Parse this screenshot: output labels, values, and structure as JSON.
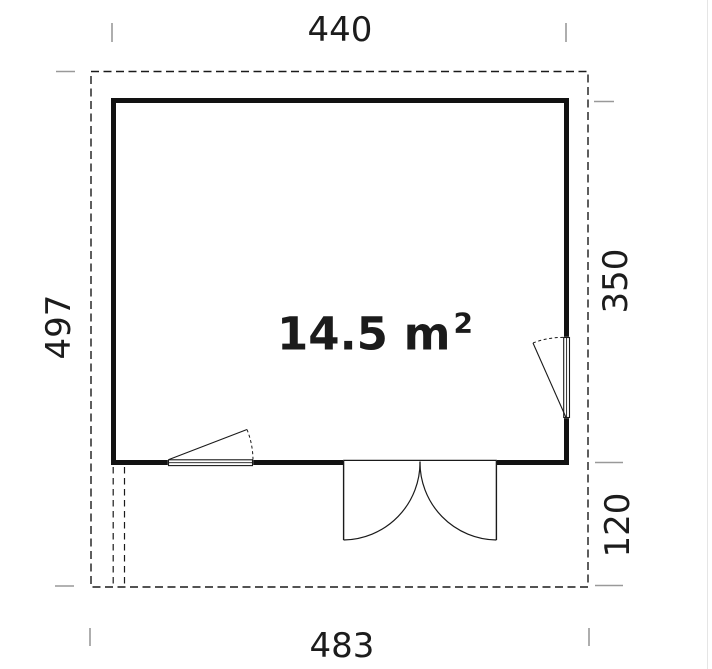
{
  "floor_plan": {
    "area_label": {
      "value": "14.5 m",
      "superscript": "2"
    },
    "dimensions": {
      "width_top": "440",
      "height_left": "497",
      "height_right_main": "350",
      "depth_right_lower": "120",
      "width_bottom": "483"
    },
    "colors": {
      "wall": "#121212",
      "thin_line": "#1a1a1a",
      "tick": "#999999",
      "page_edge": "#e5e5e5",
      "background": "#ffffff"
    }
  }
}
